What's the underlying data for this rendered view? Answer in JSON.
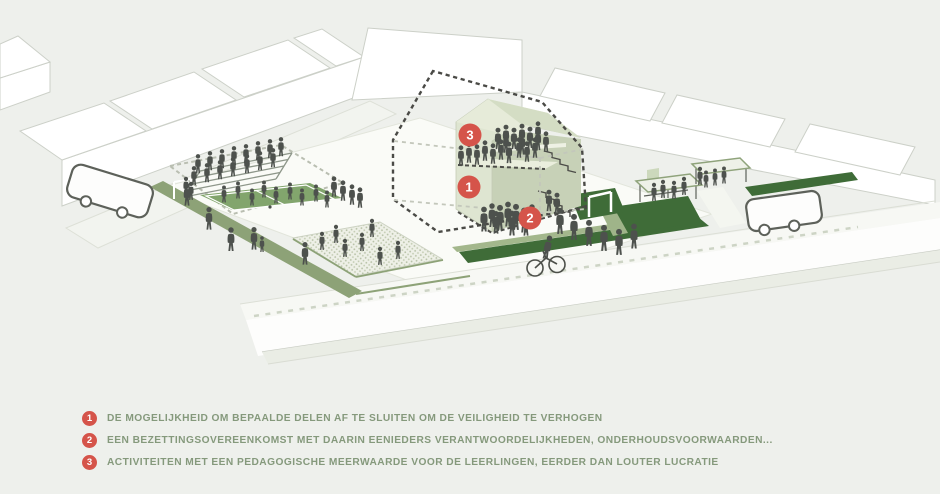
{
  "markers": {
    "m1": "1",
    "m2": "2",
    "m3": "3"
  },
  "legend": [
    {
      "num": "1",
      "text": "DE MOGELIJKHEID OM BEPAALDE DELEN AF TE SLUITEN OM DE VEILIGHEID TE VERHOGEN"
    },
    {
      "num": "2",
      "text": "EEN BEZETTINGSOVEREENKOMST MET DAARIN EENIEDERS VERANTWOORDELIJKHEDEN, ONDERHOUDSVOORWAARDEN..."
    },
    {
      "num": "3",
      "text": "ACTIVITEITEN MET EEN PEDAGOGISCHE MEERWAARDE VOOR DE LEERLINGEN, EERDER DAN LOUTER LUCRATIE"
    }
  ],
  "colors": {
    "background": "#eef0ec",
    "marker_red": "#d5544a",
    "legend_text_green": "#85997c",
    "dark_grass": "#3f6c38",
    "olive_path": "#8da277",
    "building_sage": "#dee5d1",
    "people_gray": "#4d514d",
    "dashed_outline": "#4a4a46"
  }
}
